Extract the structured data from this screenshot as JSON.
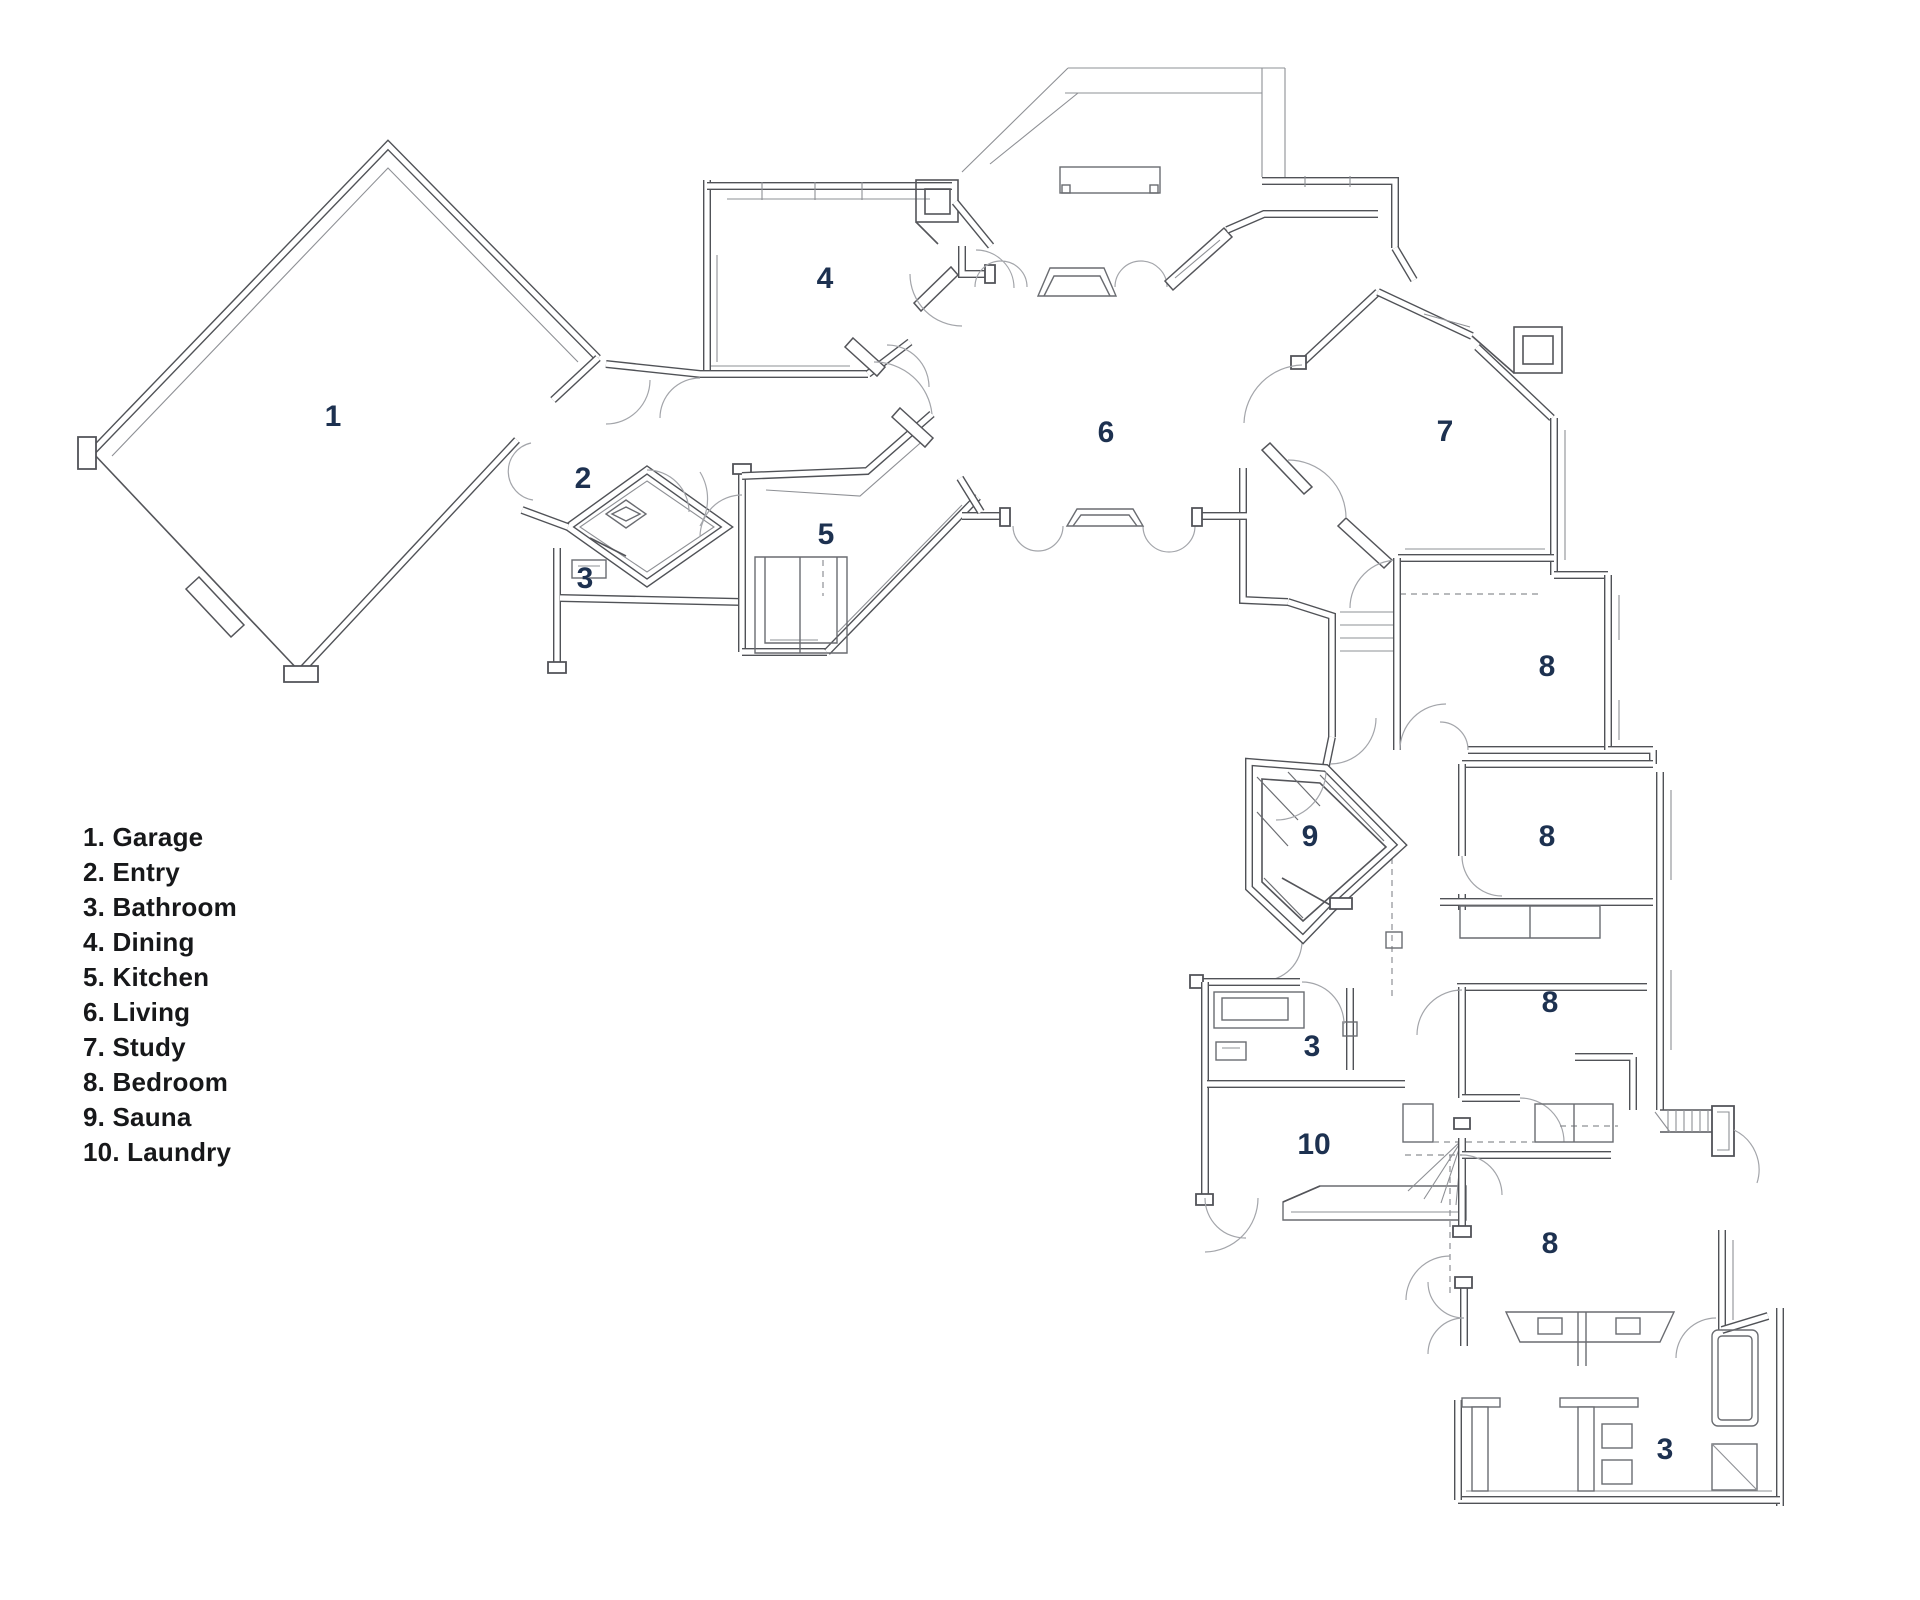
{
  "title": "House floor plan",
  "palette": {
    "background": "#ffffff",
    "wall_line": "#505257",
    "thin_line": "#8e9095",
    "door_arc": "#a3a5aa",
    "room_number": "#1d3150",
    "legend_text": "#17181a"
  },
  "legend": {
    "items": [
      "1. Garage",
      "2. Entry",
      "3. Bathroom",
      "4. Dining",
      "5. Kitchen",
      "6. Living",
      "7. Study",
      "8. Bedroom",
      "9. Sauna",
      "10. Laundry"
    ]
  },
  "plan": {
    "labels": [
      {
        "room": "garage",
        "text": "1"
      },
      {
        "room": "entry",
        "text": "2"
      },
      {
        "room": "bathroom-entry",
        "text": "3"
      },
      {
        "room": "dining",
        "text": "4"
      },
      {
        "room": "kitchen",
        "text": "5"
      },
      {
        "room": "living",
        "text": "6"
      },
      {
        "room": "study",
        "text": "7"
      },
      {
        "room": "bedroom-1",
        "text": "8"
      },
      {
        "room": "bedroom-2",
        "text": "8"
      },
      {
        "room": "sauna",
        "text": "9"
      },
      {
        "room": "bedroom-3",
        "text": "8"
      },
      {
        "room": "bathroom-mid",
        "text": "3"
      },
      {
        "room": "laundry",
        "text": "10"
      },
      {
        "room": "bedroom-4",
        "text": "8"
      },
      {
        "room": "bathroom-master",
        "text": "3"
      }
    ]
  }
}
